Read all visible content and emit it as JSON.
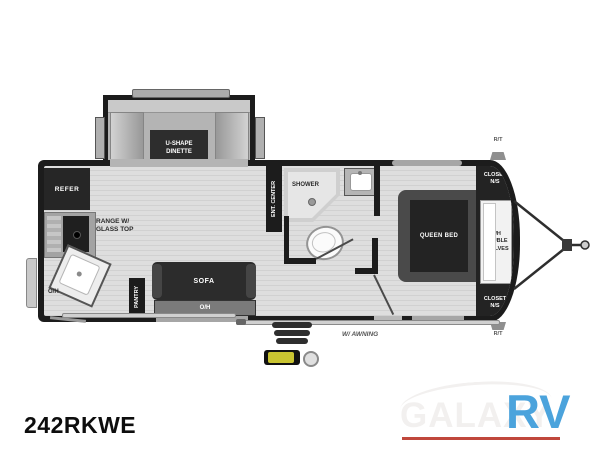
{
  "model_number": "242RKWE",
  "brand": {
    "galaxy": "GALAXY",
    "rv": "RV"
  },
  "colors": {
    "accent_blue": "#4BA3DC",
    "accent_red": "#C0473C",
    "wall_dark": "#1C1C1C",
    "floor_gray": "#DCDCDC",
    "badge_yellow": "#C9C431"
  },
  "floorplan": {
    "slide": {
      "dinette": "U-SHAPE\nDINETTE"
    },
    "kitchen": {
      "refer": "REFER",
      "range": "RANGE W/\nGLASS TOP",
      "sink_overhead": "O/H",
      "pantry": "PANTRY"
    },
    "living": {
      "sofa": "SOFA",
      "sofa_overhead": "O/H",
      "ent_center": "ENT. CENTER"
    },
    "bath": {
      "shower": "SHOWER"
    },
    "bedroom": {
      "queen_bed": "QUEEN BED",
      "closet_top": "CLOSET\nN/S",
      "shelves": "O/H\nDOUBLE\nSHELVES",
      "closet_bottom": "CLOSET\nN/S"
    },
    "exterior": {
      "awning": "W/ AWNING",
      "marker_top": "R/T",
      "marker_bottom": "R/T"
    }
  }
}
